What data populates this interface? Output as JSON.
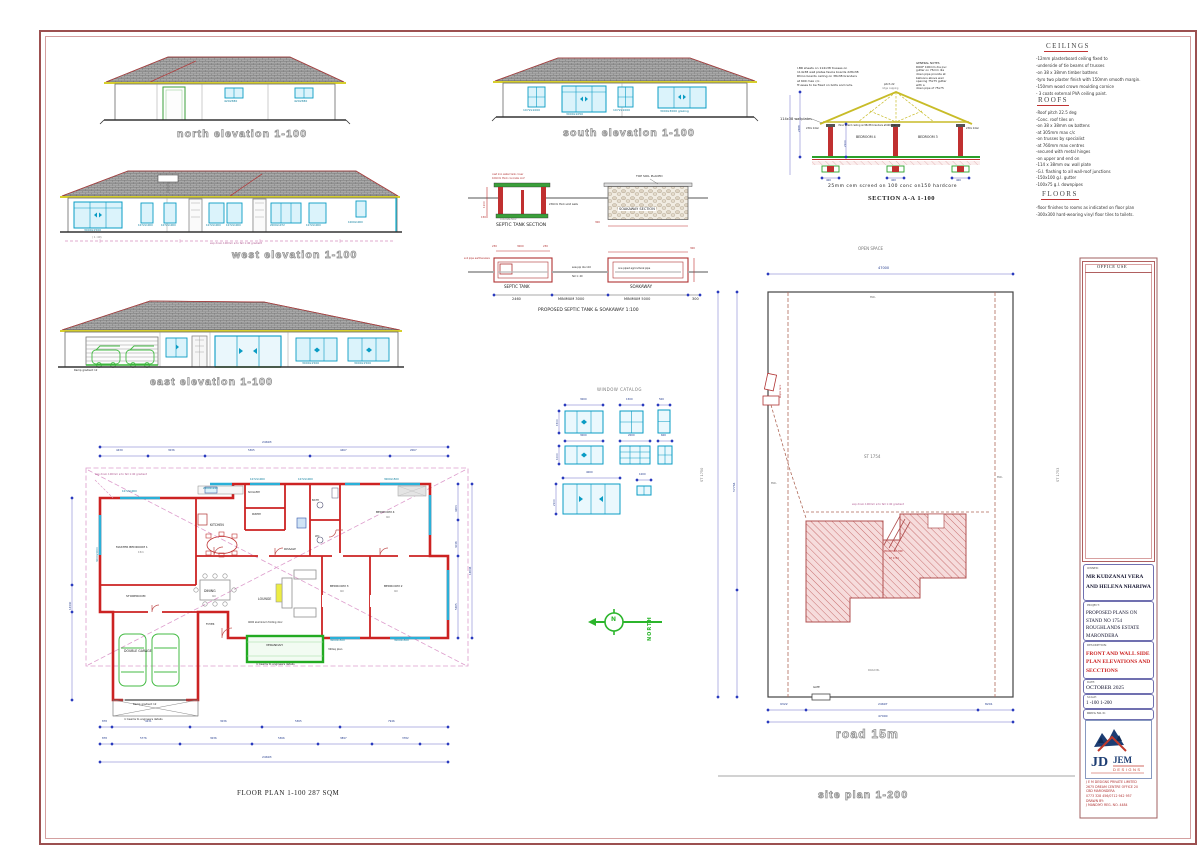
{
  "captions": {
    "north": "north  elevation   1-100",
    "south": "south  elevation   1-100",
    "west": "west  elevation   1-100",
    "east": "east  elevation   1-100",
    "section": "SECTION A-A    1-100",
    "septic": "PROPOSED SEPTIC TANK & SOAKAWAY 1:100",
    "window_catalog": "WINDOW CATALOG",
    "floor_plan": "FLOOR  PLAN 1-100   287 SQM",
    "road": "road  15m",
    "site_plan": "site  plan  1-200"
  },
  "notes_panel": {
    "ceilings_title": "CEILINGS",
    "ceilings": [
      "-12mm plasterboard ceiling fixed to",
      "-underside of tie beams of trusses",
      "-on 38 x 38mm timber battens",
      "-tyro two plaster finish with 150mm smooth margin.",
      "-150mm wood crown moulding cornice",
      "- 3 coats external PVA ceiling paint."
    ],
    "roofs_title": "ROOFS",
    "roofs": [
      "-Roof pitch    22.5 deg",
      "-Conc. roof tiles on",
      "-on 38 x 38mm sw battens",
      "-at 305mm max  c/c",
      "-on  trusses by specialist",
      "-at 760mm max centres",
      "-secured with metal hinges",
      "-on  upper and end on",
      "-114 x 38mm sw. wall plate",
      "-G.I. flashing to all wall-roof junctions",
      "-150x100 g.I. gutter",
      "-100x75  g.I. downpipes"
    ],
    "floors_title": "FLOORS",
    "floors": [
      "-floor  finishes to rooms as indicated on floor plan",
      "-300x300 hard-wearing vinyl floor tiles to toilets."
    ]
  },
  "elevations": {
    "north": {
      "w": [
        "420x580",
        "420x580"
      ]
    },
    "south": {
      "w": [
        "1072x1000",
        "3000x1050",
        "1072x1000",
        "3000x3000 glazing"
      ]
    },
    "west": {
      "w": [
        "3000x1500",
        "1072x1000",
        "1072x1000",
        "1072x1000",
        "1072x1000",
        "2000x1072",
        "1072x1000",
        "1000x1000"
      ],
      "drain": "exp drain 100mm ø to fall 1:40 gradient",
      "grade": "( 1 :40)"
    },
    "east": {
      "w": [
        "3000x1500",
        "3000x1500"
      ],
      "ramp": "Ramp gradient 12"
    }
  },
  "section": {
    "left_note": [
      "I.BR sheets on 114x38 trusses on",
      "114x38 wall plates fascia boards 228x38",
      "Rhino boards ceiling on 38x38 branders",
      "at 600 max c/c.",
      "Trusses to be fixed on bolts and nuts."
    ],
    "general_note": [
      "GENERAL NOTES",
      "ROOF 100mm dia pvc",
      "gutter on 75mm dia",
      "down pipe provide at",
      "balloons above weir",
      "opening 75x75 gutter",
      "with a",
      "down pipe of 75x75"
    ],
    "wallplates": "114x38  wallplates",
    "pitch": "pitch 22",
    "ridge": "ridge capping",
    "ceiling": "rhino board ceiling on38x38 branders at400 max c/c",
    "lintel": "230x lintel",
    "room_a": "BEDROOM 4",
    "room_b": "BEDROOM 3",
    "dim_a": "2388",
    "dim_b": "2100",
    "dim_c": "400",
    "screed": "25mm  cem  screed  on  100  conc  on150  hardcore"
  },
  "septic": {
    "cover": "cast iron water tank cover",
    "slab": "100mm thick concrete roof",
    "walls": "230mm thick solid walls",
    "floor": "concrete floor",
    "tank_section": "SEPTIC TANK  SECTION",
    "soak_section": "SOAKAWAY  SECTION",
    "topsoil": "TOP SOIL PLACED",
    "soil_pipe": "soil pipe earthenware",
    "sew": "sew pip dia 110",
    "fall": "fall 1: 40",
    "agri": "one piped agricultural pipe",
    "tank": "SEPTIC TANK",
    "soak": "SOAKAWAY",
    "d2460": "2460",
    "min3000": "MINIMUM  3000",
    "min5000": "MINIMUM  5000",
    "d300": "300",
    "d1100": "1100",
    "d150": "150",
    "d230": "230",
    "d3000": "3000"
  },
  "window_catalog": {
    "d3000": "3000",
    "d1500": "1500",
    "d500": "500",
    "d2000": "2000",
    "d600": "600",
    "d4000": "4000",
    "d1000": "1000",
    "d2100": "2100"
  },
  "floor_plan": {
    "rooms": {
      "master": "MASTER BEDROOM 1",
      "master_s": "15m",
      "kitchen": "KITCHEN",
      "scullery": "SCULLERY",
      "pantry": "PANTRY",
      "dining": "DINING",
      "dining_s": "9m",
      "lounge": "LOUNGE",
      "passage": "PASSAGE",
      "storeroom": "STOREROOM",
      "garage": "DOUBLE GARAGE",
      "bed2": "BEDROOM 2",
      "bed3": "BEDROOM 3",
      "bed4": "BEDROOM 4",
      "room_s": "9m",
      "bath": "BATH",
      "wc": "WC",
      "verandah": "VERANDAH",
      "foyer": "FOYER"
    },
    "notes": {
      "drain": "exp drain 100mm ø to fall 1:40 gradient",
      "rc": "rc beams to engineers details",
      "ramp": "Ramp gradient 12",
      "sq": "320sq plan",
      "door": "4000 aluminium folding door"
    },
    "w": [
      "1072x1000",
      "2000x1240",
      "1072x1000",
      "1072x1000",
      "3000x1500",
      "3000x1500",
      "3000x1500",
      "3000x3000"
    ],
    "dims": {
      "top_total": "24693",
      "top_row": [
        "4439",
        "3036",
        "5365",
        "4467",
        "2067"
      ],
      "row1": [
        "878",
        "4231",
        "3036",
        "5365",
        "7946"
      ],
      "row2": [
        "878",
        "5776",
        "3036",
        "5366",
        "3897",
        "3782"
      ],
      "total": "24693",
      "right": [
        "4263",
        "3036",
        "5365"
      ],
      "right_total": "14646",
      "left_total": "14340"
    }
  },
  "compass": {
    "n": "N",
    "label": "NORTH"
  },
  "site_plan": {
    "open_space": "OPEN SPACE",
    "stand": "ST 1754",
    "stand_left": "ST 1750",
    "stand_right": "ST 1753",
    "bwl": "BWL",
    "top_dim": "47000",
    "d1": "9322",
    "d2": "24697",
    "d3": "8201",
    "total": "47000",
    "left_dim": "57764",
    "gate": "GATE",
    "road_bl": "ROAD BL",
    "hse1": "PROPOSED HSE",
    "hse2": "ST 1754",
    "drain": "exp drain 100mm ø to fall 1:40 gradient",
    "septic": "septic tank"
  },
  "title_block": {
    "office_use": "OFFICE  USE",
    "owner_label": "OWNER:",
    "owner1": "MR KUDZANAI VERA",
    "owner2": "AND HELENA NHARIWA",
    "project_label": "PROJECT:",
    "project": [
      "PROPOSED   PLANS   ON",
      "STAND NO 1754",
      "ROUGHLANDS ESTATE",
      "MARONDERA"
    ],
    "desc_label": "DESCRIPTION:",
    "desc": [
      "FRONT AND WALL SIDE",
      "PLAN ELEVATIONS AND",
      "SECCTIONS"
    ],
    "date_label": "DATE:",
    "date": "OCTOBER 2025",
    "scale_label": "SCALE:",
    "scale": "1 -100  1-200",
    "drwg": "DRWG NO. 01",
    "logo": {
      "jd": "JD",
      "jem": "JEM",
      "sub": "DESIGNS"
    },
    "company": [
      "J E M DESIGNS PRIVATE LIMITED",
      "2675 DREAM CENTRE OFFICE 20",
      "CBD  MARONDERA",
      "0773 328 456/0712 942 957",
      "DRAWN BY:",
      "J MANDIYO  REG. NO. 4484"
    ]
  }
}
